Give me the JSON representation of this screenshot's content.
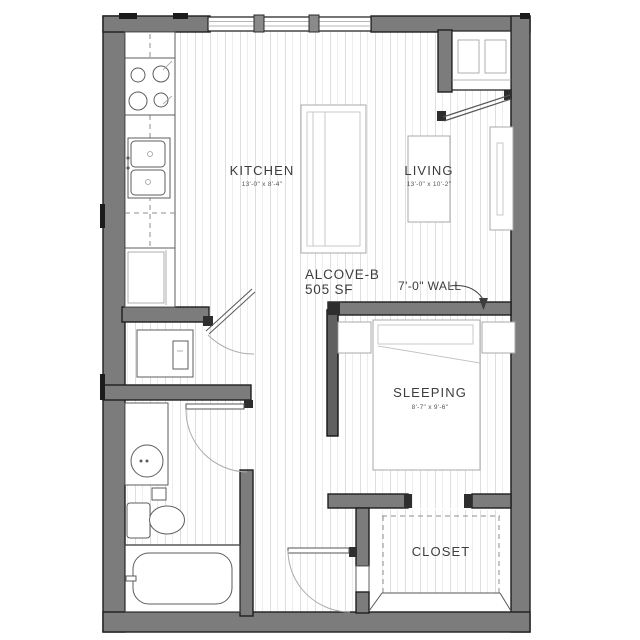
{
  "unit": {
    "name": "ALCOVE-B",
    "area": "505 SF"
  },
  "rooms": {
    "kitchen": {
      "label": "KITCHEN",
      "dims": "13'-0\" x 8'-4\""
    },
    "living": {
      "label": "LIVING",
      "dims": "13'-0\" x 10'-2\""
    },
    "sleeping": {
      "label": "SLEEPING",
      "dims": "8'-7\" x 9'-6\""
    },
    "closet": {
      "label": "CLOSET"
    }
  },
  "annotations": {
    "wall_note": "7'-0\" WALL"
  },
  "colors": {
    "wall": "#7c7c7c",
    "tall_wall": "#606060",
    "outline": "#1f1f1f",
    "floor_line": "#e0e0e0",
    "fixture_line": "#8f8f8f",
    "text": "#3d3d3d",
    "background": "#ffffff"
  },
  "fixtures": [
    "range-stove",
    "kitchen-sink",
    "refrigerator",
    "kitchen-island",
    "washer-dryer",
    "bathroom-vanity",
    "toilet",
    "bathtub",
    "shower-curtain",
    "bed",
    "nightstand",
    "coffee-table",
    "media-console",
    "entry-door",
    "window",
    "closet-shelving"
  ]
}
